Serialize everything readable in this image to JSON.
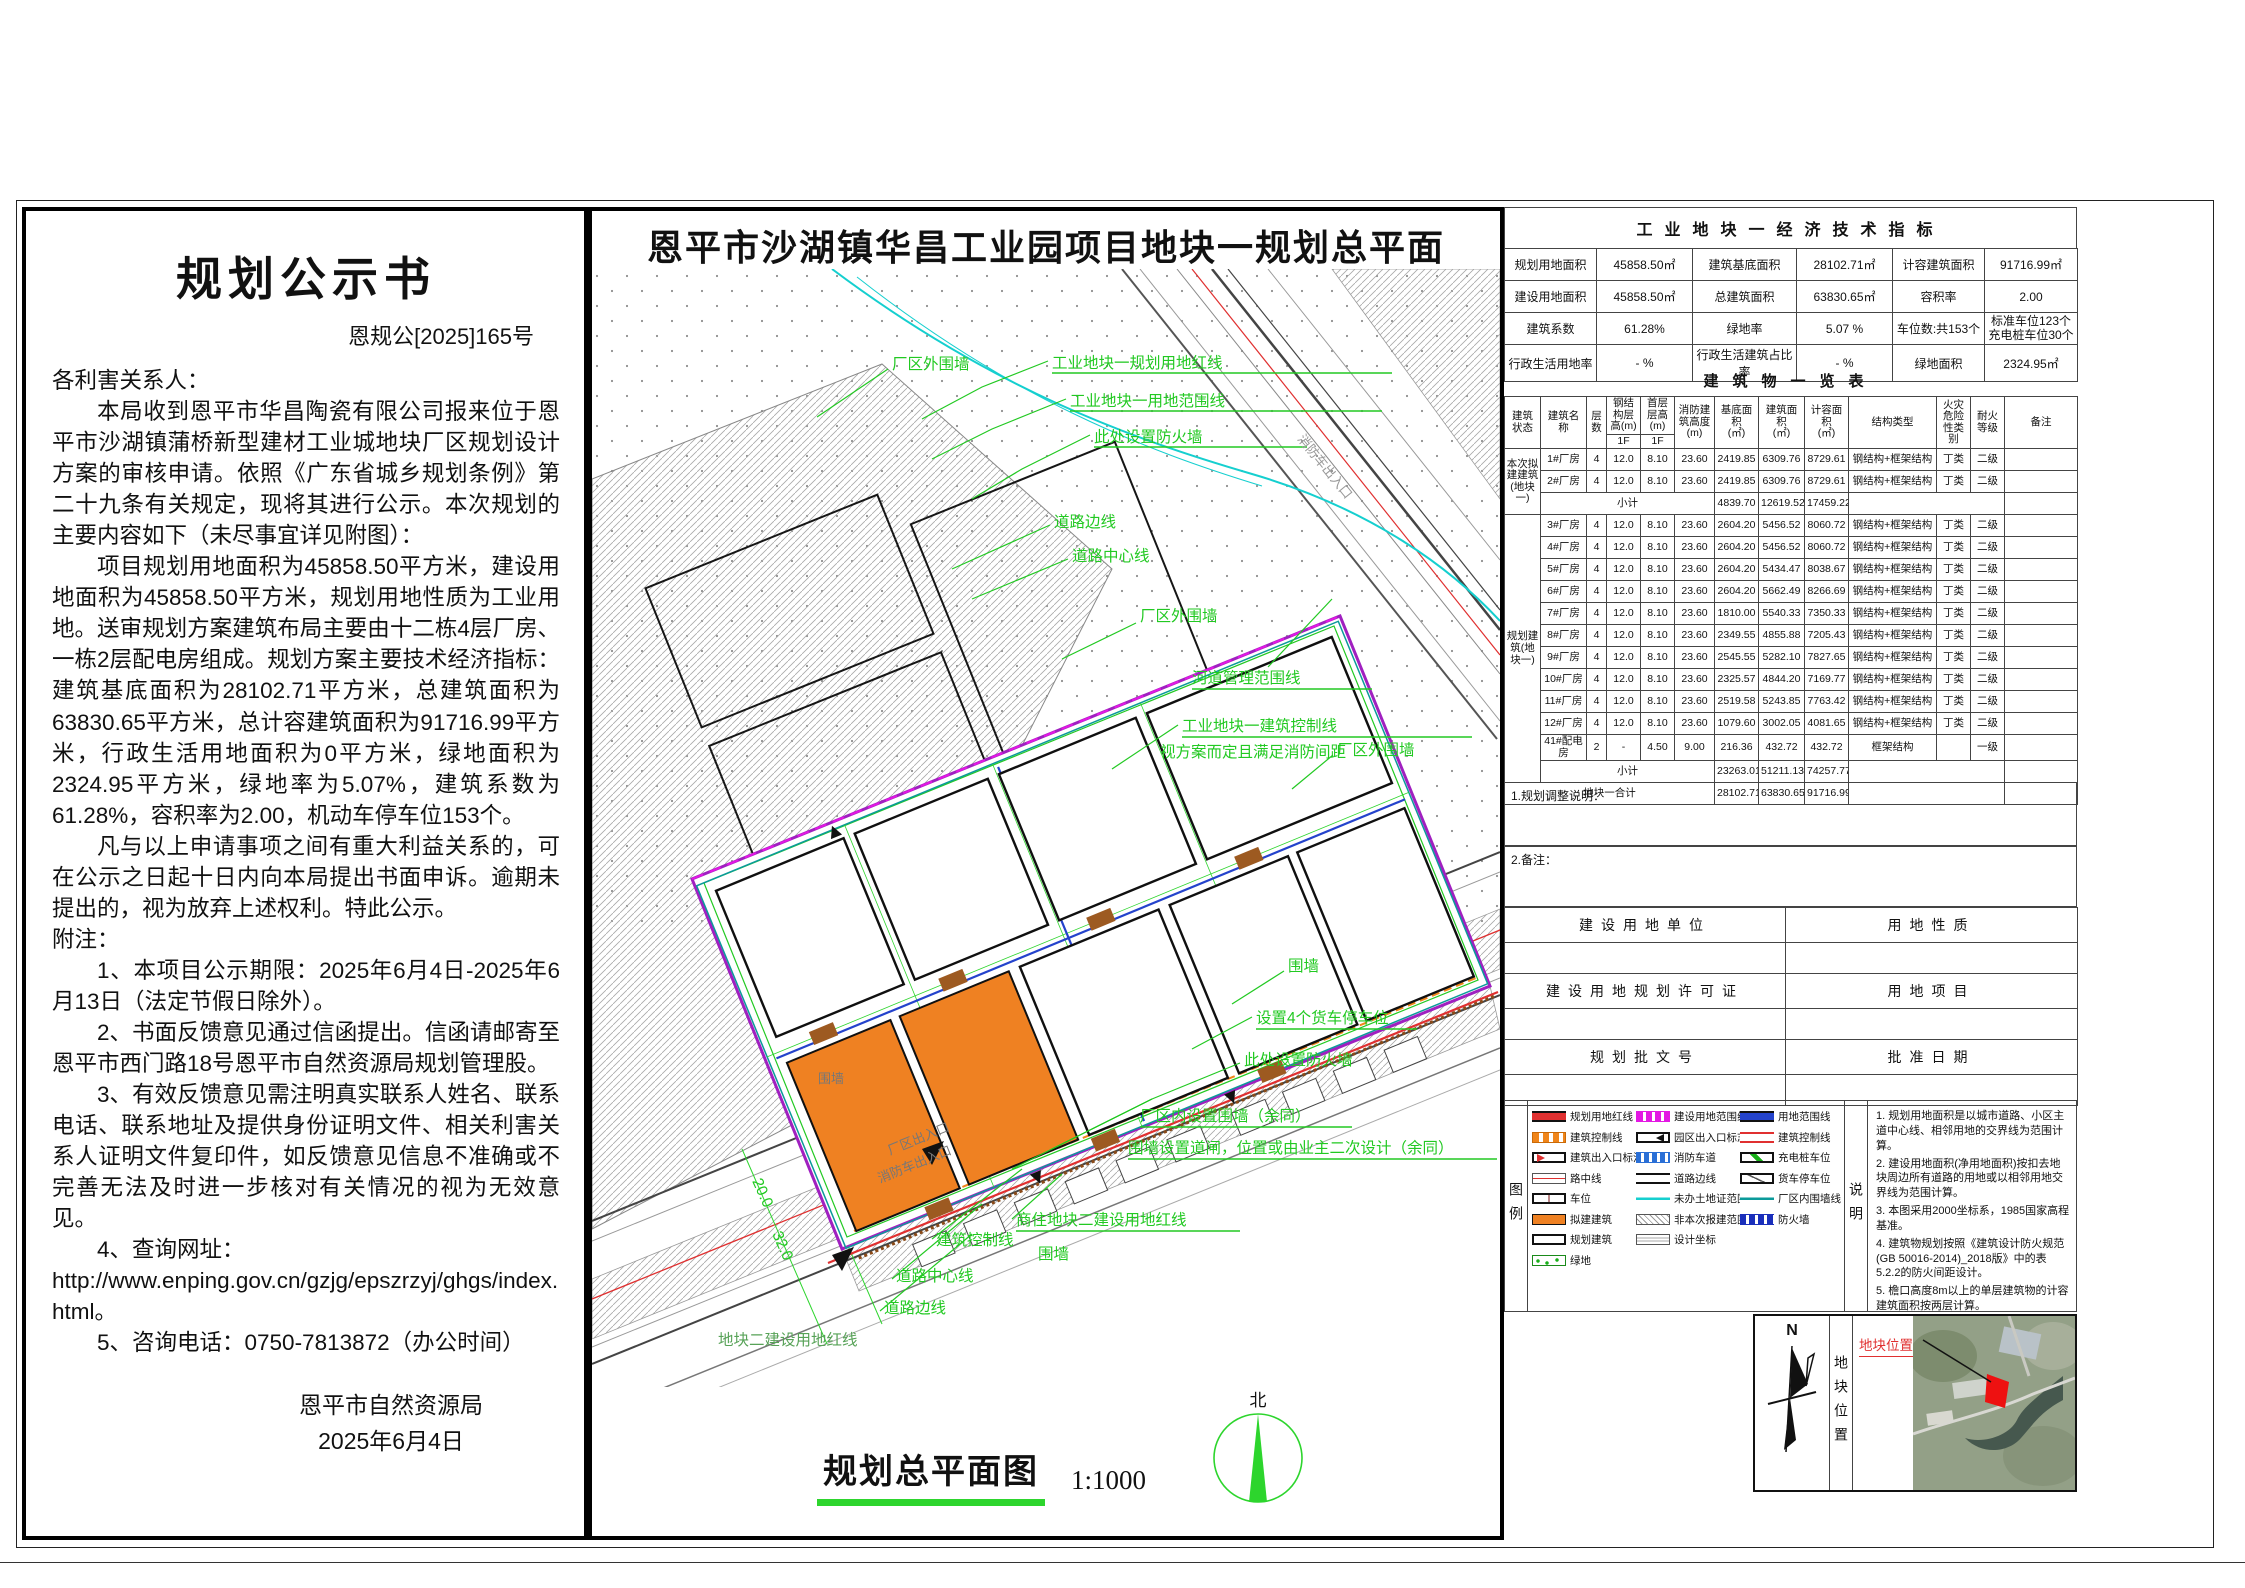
{
  "doc": {
    "title": "规划公示书",
    "doc_no": "恩规公[2025]165号",
    "paragraphs": [
      {
        "t": "各利害关系人：",
        "c": "p-noind"
      },
      {
        "t": "本局收到恩平市华昌陶瓷有限公司报来位于恩平市沙湖镇蒲桥新型建材工业城地块厂区规划设计方案的审核申请。依照《广东省城乡规划条例》第二十九条有关规定，现将其进行公示。本次规划的主要内容如下（未尽事宜详见附图）：",
        "c": "p-ind"
      },
      {
        "t": "项目规划用地面积为45858.50平方米，建设用地面积为45858.50平方米，规划用地性质为工业用地。送审规划方案建筑布局主要由十二栋4层厂房、一栋2层配电房组成。规划方案主要技术经济指标：建筑基底面积为28102.71平方米，总建筑面积为63830.65平方米，总计容建筑面积为91716.99平方米，行政生活用地面积为0平方米，绿地面积为2324.95平方米，绿地率为5.07%，建筑系数为61.28%，容积率为2.00，机动车停车位153个。",
        "c": "p-ind"
      },
      {
        "t": "凡与以上申请事项之间有重大利益关系的，可在公示之日起十日内向本局提出书面申诉。逾期未提出的，视为放弃上述权利。特此公示。",
        "c": "p-ind"
      },
      {
        "t": "附注：",
        "c": "p-noind"
      },
      {
        "t": "1、本项目公示期限：2025年6月4日-2025年6月13日（法定节假日除外）。",
        "c": "p-ind"
      },
      {
        "t": "2、书面反馈意见通过信函提出。信函请邮寄至恩平市西门路18号恩平市自然资源局规划管理股。",
        "c": "p-ind"
      },
      {
        "t": "3、有效反馈意见需注明真实联系人姓名、联系电话、联系地址及提供身份证明文件、相关利害关系人证明文件复印件，如反馈意见信息不准确或不完善无法及时进一步核对有关情况的视为无效意见。",
        "c": "p-ind"
      },
      {
        "t": "4、查询网址：",
        "c": "p-ind"
      },
      {
        "t": "http://www.enping.gov.cn/gzjg/epszrzyj/ghgs/index.html。",
        "c": "p-url"
      },
      {
        "t": "5、咨询电话：0750-7813872（办公时间）",
        "c": "p-ind"
      }
    ],
    "signature": "恩平市自然资源局",
    "date": "2025年6月4日"
  },
  "map": {
    "title": "恩平市沙湖镇华昌工业园项目地块一规划总平面",
    "caption": "规划总平面图",
    "scale": "1:1000",
    "north": "北",
    "labels": {
      "outer_wall": "厂区外围墙",
      "redline": "工业地块一规划用地红线",
      "scope": "工业地块一用地范围线",
      "firewall_here": "此处设置防火墙",
      "road_edge": "道路边线",
      "road_center": "道路中心线",
      "river": "河道管理范围线",
      "ctrl_line": "工业地块一建筑控制线",
      "ctrl_note": "视方案而定且满足消防间距",
      "wall": "围墙",
      "truck": "设置4个货车停车位",
      "inner_wall": "厂区内设置围墙（余同）",
      "gate": "围墙设置道闸，位置或由业主二次设计（余同）",
      "block2_red": "商住地块二建设用地红线",
      "bldg_ctrl": "建筑控制线",
      "block2_red2": "地块二建设用地红线",
      "entrance": "厂区出入口",
      "fire_entrance": "消防车出入口",
      "dim20": "20.0",
      "dim32": "32.0"
    }
  },
  "ind": {
    "title": "工业地块一经济技术指标",
    "rows": [
      [
        "规划用地面积",
        "45858.50㎡",
        "建筑基底面积",
        "28102.71㎡",
        "计容建筑面积",
        "91716.99㎡"
      ],
      [
        "建设用地面积",
        "45858.50㎡",
        "总建筑面积",
        "63830.65㎡",
        "容积率",
        "2.00"
      ],
      [
        "建筑系数",
        "61.28%",
        "绿地率",
        "5.07 %",
        "车位数:共153个",
        "标准车位123个"
      ],
      [
        "行政生活用地率",
        "- %",
        "行政生活建筑占比率",
        "- %",
        "绿地面积",
        "2324.95㎡"
      ]
    ],
    "parking2": "充电桩车位30个"
  },
  "bld": {
    "title": "建筑物一览表",
    "hd": {
      "c1": "建筑状态",
      "c2": "建筑名称",
      "c3": "层数",
      "c4": "钢结构层高(m)",
      "c4s": "1F",
      "c5": "首层层高(m)",
      "c5s": "1F",
      "c6a": "消防建筑高度",
      "c6b": "(m)",
      "c7a": "基底面积",
      "c7b": "(㎡)",
      "c8a": "建筑面积",
      "c8b": "(㎡)",
      "c9a": "计容面积",
      "c9b": "(㎡)",
      "c10": "结构类型",
      "c11a": "火灾危险",
      "c11b": "性类别",
      "c12a": "耐火",
      "c12b": "等级",
      "c13": "备注"
    },
    "g1": "本次拟建建筑(地块一)",
    "g2": "规划建筑(地块一)",
    "r1": [
      "1#厂房",
      "4",
      "12.0",
      "8.10",
      "23.60",
      "2419.85",
      "6309.76",
      "8729.61",
      "钢结构+框架结构",
      "丁类",
      "二级"
    ],
    "r2": [
      "2#厂房",
      "4",
      "12.0",
      "8.10",
      "23.60",
      "2419.85",
      "6309.76",
      "8729.61",
      "钢结构+框架结构",
      "丁类",
      "二级"
    ],
    "st1": [
      "小计",
      "4839.70",
      "12619.52",
      "17459.22"
    ],
    "r3": [
      "3#厂房",
      "4",
      "12.0",
      "8.10",
      "23.60",
      "2604.20",
      "5456.52",
      "8060.72",
      "钢结构+框架结构",
      "丁类",
      "二级"
    ],
    "r4": [
      "4#厂房",
      "4",
      "12.0",
      "8.10",
      "23.60",
      "2604.20",
      "5456.52",
      "8060.72",
      "钢结构+框架结构",
      "丁类",
      "二级"
    ],
    "r5": [
      "5#厂房",
      "4",
      "12.0",
      "8.10",
      "23.60",
      "2604.20",
      "5434.47",
      "8038.67",
      "钢结构+框架结构",
      "丁类",
      "二级"
    ],
    "r6": [
      "6#厂房",
      "4",
      "12.0",
      "8.10",
      "23.60",
      "2604.20",
      "5662.49",
      "8266.69",
      "钢结构+框架结构",
      "丁类",
      "二级"
    ],
    "r7": [
      "7#厂房",
      "4",
      "12.0",
      "8.10",
      "23.60",
      "1810.00",
      "5540.33",
      "7350.33",
      "钢结构+框架结构",
      "丁类",
      "二级"
    ],
    "r8": [
      "8#厂房",
      "4",
      "12.0",
      "8.10",
      "23.60",
      "2349.55",
      "4855.88",
      "7205.43",
      "钢结构+框架结构",
      "丁类",
      "二级"
    ],
    "r9": [
      "9#厂房",
      "4",
      "12.0",
      "8.10",
      "23.60",
      "2545.55",
      "5282.10",
      "7827.65",
      "钢结构+框架结构",
      "丁类",
      "二级"
    ],
    "r10": [
      "10#厂房",
      "4",
      "12.0",
      "8.10",
      "23.60",
      "2325.57",
      "4844.20",
      "7169.77",
      "钢结构+框架结构",
      "丁类",
      "二级"
    ],
    "r11": [
      "11#厂房",
      "4",
      "12.0",
      "8.10",
      "23.60",
      "2519.58",
      "5243.85",
      "7763.42",
      "钢结构+框架结构",
      "丁类",
      "二级"
    ],
    "r12": [
      "12#厂房",
      "4",
      "12.0",
      "8.10",
      "23.60",
      "1079.60",
      "3002.05",
      "4081.65",
      "钢结构+框架结构",
      "丁类",
      "二级"
    ],
    "r41": [
      "41#配电房",
      "2",
      "-",
      "4.50",
      "9.00",
      "216.36",
      "432.72",
      "432.72",
      "框架结构",
      "",
      "一级"
    ],
    "st2": [
      "小计",
      "23263.01",
      "51211.13",
      "74257.77"
    ],
    "total": [
      "地块一合计",
      "28102.71",
      "63830.65",
      "91716.99"
    ]
  },
  "sections": {
    "adjust": "1.规划调整说明：",
    "remark": "2.备注："
  },
  "approval": {
    "rows": [
      {
        "l": "建设用地单位",
        "r": "用地性质"
      },
      {
        "l": "建设用地规划许可证",
        "r": "用地项目"
      },
      {
        "l": "规划批文号",
        "r": "批准日期"
      }
    ]
  },
  "legend": {
    "label": "图例",
    "col1": [
      {
        "s": "sym-redline",
        "t": "规划用地红线"
      },
      {
        "s": "sym-ctrlorange",
        "t": "建筑控制线"
      },
      {
        "s": "sym-bentrance",
        "t": "建筑出入口标注"
      },
      {
        "s": "sym-roadcenter",
        "t": "路中线"
      },
      {
        "s": "sym-parkspot",
        "t": "车位"
      },
      {
        "s": "sym-proposed",
        "t": "拟建建筑"
      },
      {
        "s": "sym-planned",
        "t": "规划建筑"
      },
      {
        "s": "sym-green",
        "t": "绿地"
      }
    ],
    "col2": [
      {
        "s": "sym-scopemagenta",
        "t": "建设用地范围线"
      },
      {
        "s": "sym-parkentrance",
        "t": "园区出入口标志"
      },
      {
        "s": "sym-firelane",
        "t": "消防车道"
      },
      {
        "s": "sym-roadedge",
        "t": "道路边线"
      },
      {
        "s": "sym-nocert",
        "t": "未办土地证范围线"
      },
      {
        "s": "sym-notthis",
        "t": "非本次报建范围"
      },
      {
        "s": "sym-coord",
        "t": "设计坐标"
      }
    ],
    "col3": [
      {
        "s": "sym-scopeblue",
        "t": "用地范围线"
      },
      {
        "s": "sym-ctrlred",
        "t": "建筑控制线"
      },
      {
        "s": "sym-charge",
        "t": "充电桩车位"
      },
      {
        "s": "sym-truckpark",
        "t": "货车停车位"
      },
      {
        "s": "sym-innerwall",
        "t": "厂区内围墙线"
      },
      {
        "s": "sym-firewall",
        "t": "防火墙"
      }
    ]
  },
  "notes": {
    "label": "说明",
    "items": [
      "1. 规划用地面积是以城市道路、小区主道中心线、相邻用地的交界线为范围计算。",
      "2. 建设用地面积(净用地面积)按扣去地块周边所有道路的用地或以相邻用地交界线为范围计算。",
      "3. 本图采用2000坐标系，1985国家高程基准。",
      "4. 建筑物规划按照《建筑设计防火规范 (GB 50016-2014)_2018版》中的表5.2.2的防火间距设计。",
      "5. 檐口高度8m以上的单层建筑物的计容建筑面积按两层计算。",
      "6. 拆除地块内所有原有建筑物、构筑物。",
      "7. 本项目用地位置：恩平市沙湖镇蒲桥新型建材工业城。"
    ]
  },
  "location": {
    "north_letter": "N",
    "side_label": "地块位置",
    "callout": "地块位置"
  }
}
